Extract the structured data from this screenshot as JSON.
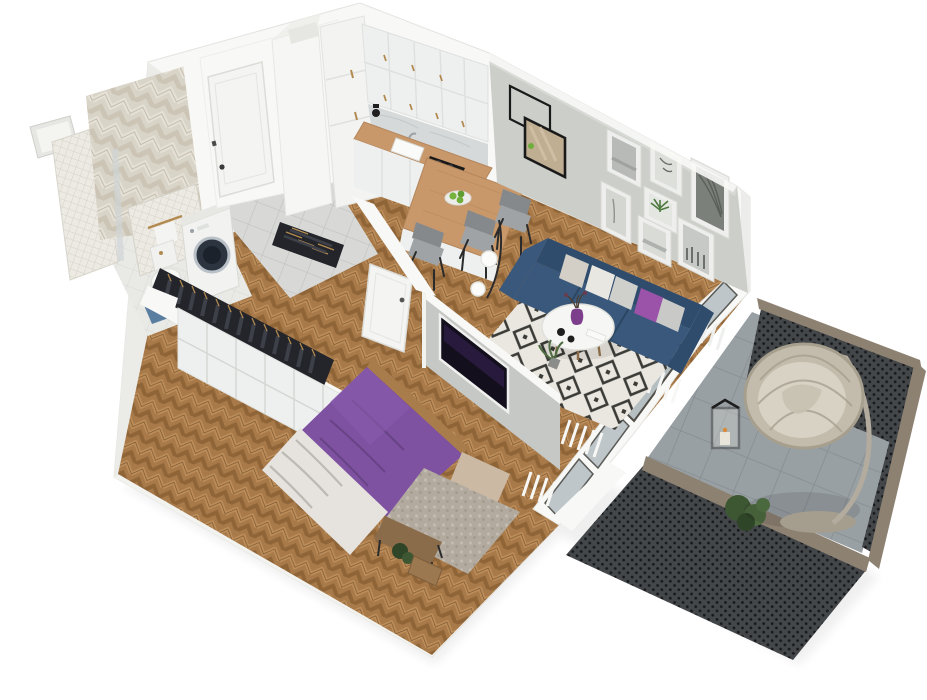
{
  "scene": {
    "aria_label": "3D isometric cutaway render of a one-bedroom apartment floor plan with balcony",
    "type": "architectural 3D floor plan render",
    "background": "#ffffff"
  },
  "colors": {
    "background": "#ffffff",
    "wall_white": "#f8f8f6",
    "wall_shade": "#ebebe8",
    "living_wall": "#cbcec9",
    "wood_floor": "#a97a49",
    "wood_floor_light": "#bd8e5a",
    "wood_floor_dark": "#8f6538",
    "sofa_navy": "#3a587b",
    "sofa_navy_dark": "#2f4c6d",
    "accent_purple": "#8453a4",
    "bed_purple": "#7e51a1",
    "pillow_purple": "#9a53a8",
    "rug_cream": "#eae7e0",
    "rug_black": "#3b3b37",
    "railing_mesh": "#3e4144",
    "railing_cap": "#8d8172",
    "balcony_tile": "#99a0a4",
    "egg_chair": "#c3bcac",
    "cabinet_white": "#eef0f0",
    "counter_wood": "#c8986b",
    "marble_backsplash": "#d6d9da",
    "bath_tile_cream": "#d9d4c8",
    "mosaic_tile": "#eceae3",
    "hall_tile": "#d8d9d7",
    "wardrobe_clothes": "#23252a",
    "brass": "#b28a50",
    "appliance_black": "#1a1a1a",
    "tv_screen": "#140f1d",
    "plant_green": "#4e6b41",
    "stone_rug": "#b2aa9f",
    "blanket_white": "#e6e3df"
  },
  "rooms": [
    {
      "id": "bathroom",
      "name": "Bathroom",
      "position": "top-left",
      "items": [
        "herringbone cream tile feature wall",
        "mosaic tile shower column",
        "mosaic half wall with brass towel bar",
        "wall-hung toilet",
        "washing machine with dark drum",
        "blue bath mat",
        "ventilation shaft opening"
      ]
    },
    {
      "id": "hallway",
      "name": "Entrance hall",
      "position": "top-center",
      "items": [
        "white entrance door with dark handle",
        "gray tile floor",
        "tall white shaft column",
        "open-top storage niche with folded clothes"
      ]
    },
    {
      "id": "kitchen",
      "name": "Kitchen",
      "position": "top-right-of-center",
      "items": [
        "white shaker upper cabinets with brass pulls",
        "tall pantry cabinet",
        "marble backsplash",
        "wood countertop",
        "white sink",
        "black cooktop",
        "built-in oven",
        "black kettle",
        "wood dining peninsula",
        "plate of green apples",
        "three gray dining chairs",
        "floor lamp with two white globes"
      ]
    },
    {
      "id": "living_room",
      "name": "Living room",
      "position": "right",
      "items": [
        "gray feature wall",
        "gallery of seven white frames (one green botanical print)",
        "leaning black-framed mirror and empty black frame",
        "navy blue three-seat sofa",
        "beige, white, gray, silver and purple cushions",
        "black and white diamond rug",
        "round white coffee table",
        "purple vase with sprigs",
        "two black cups",
        "potted plants",
        "black floor lamp",
        "white radiator slats under windows",
        "floor-to-ceiling windows"
      ]
    },
    {
      "id": "wardrobe",
      "name": "Wardrobe corridor",
      "position": "center-left",
      "items": [
        "open closet with dark hanging clothes on brass hangers",
        "white cabinet fronts",
        "open white door to bedroom"
      ]
    },
    {
      "id": "bedroom",
      "name": "Bedroom",
      "position": "bottom-center",
      "items": [
        "double bed with purple duvet",
        "crumpled white blanket",
        "wood bed frame",
        "beige headboard cushion",
        "wood bench at bed foot",
        "speckled stone-gray rug",
        "TV on partition wall",
        "small wood chest",
        "potted plant",
        "window with radiator"
      ]
    },
    {
      "id": "balcony",
      "name": "Balcony",
      "position": "right-bottom",
      "items": [
        "gray tile floor",
        "dark perforated metal railing with taupe wood cap",
        "hanging rattan egg chair on stand",
        "black candle lantern",
        "green plants"
      ]
    }
  ]
}
